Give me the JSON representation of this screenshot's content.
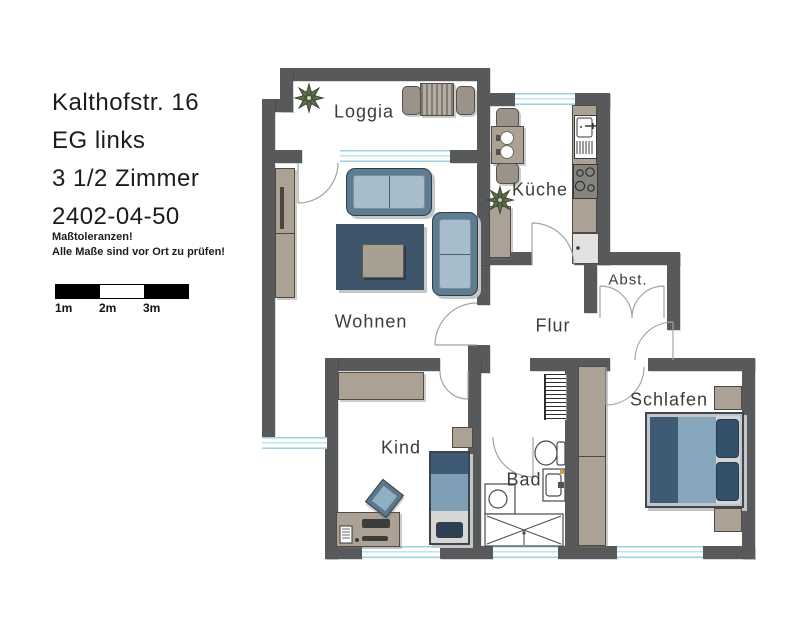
{
  "header": {
    "address": "Kalthofstr. 16",
    "floor": "EG links",
    "apartment_type": "3 1/2 Zimmer",
    "unit_number": "2402-04-50"
  },
  "notice": {
    "line1": "Maßtoleranzen!",
    "line2": "Alle Maße sind vor Ort zu prüfen!"
  },
  "scale_bar": {
    "labels": [
      "1m",
      "2m",
      "3m"
    ]
  },
  "rooms": {
    "loggia": "Loggia",
    "kueche": "Küche",
    "wohnen": "Wohnen",
    "flur": "Flur",
    "abstellraum": "Abst.",
    "kind": "Kind",
    "bad": "Bad",
    "schlafen": "Schlafen"
  },
  "colors": {
    "wall": "#58595a",
    "furniture_wood": "#aba295",
    "sofa_frame": "#5e7d91",
    "sofa_cushion": "#a7bdcb",
    "rug_dark_blue": "#3d5469",
    "bed_blanket_dark": "#3f5a74",
    "bed_blanket_light": "#87a7bd",
    "window_glass": "#bfe2ec",
    "plant_green": "#5f6e4b",
    "door_arc": "#a3a3a1"
  }
}
